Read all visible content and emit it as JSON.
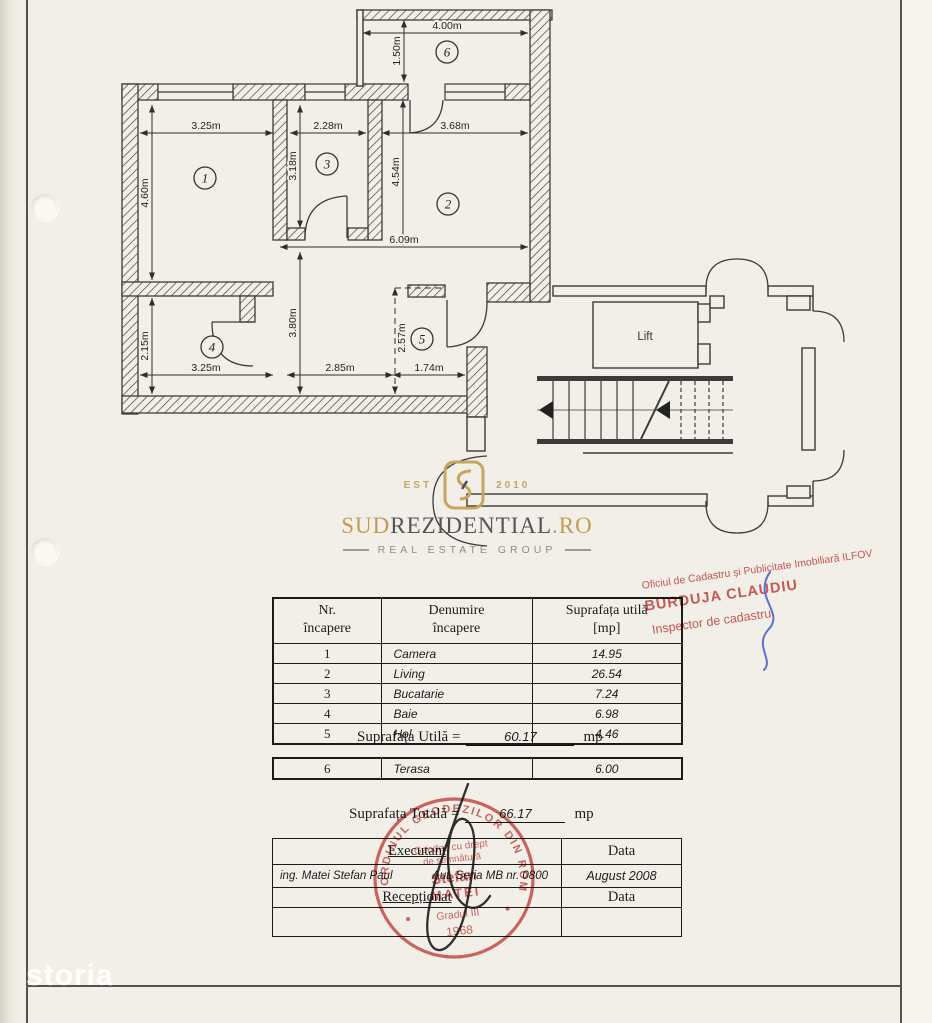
{
  "colors": {
    "stamp_red": "#cf4f4b",
    "logo_gold": "#c39a55",
    "ink": "#3b3b3b"
  },
  "watermark": "storia",
  "plan": {
    "lift_label": "Lift",
    "room_numbers": {
      "r1": "1",
      "r2": "2",
      "r3": "3",
      "r4": "4",
      "r5": "5",
      "r6": "6"
    },
    "dims": {
      "terasa_w": "4.00m",
      "terasa_h": "1.50m",
      "room1_w": "3.25m",
      "room3_w": "2.28m",
      "room2_w": "3.68m",
      "room1_h": "4.60m",
      "room3_h": "3.18m",
      "room2_h": "4.54m",
      "hall_w": "6.09m",
      "hall_h": "3.80m",
      "room5_h": "2.57m",
      "room4_h": "2.15m",
      "room4_w": "3.25m",
      "hall2_w": "2.85m",
      "room5_w": "1.74m"
    }
  },
  "logo": {
    "est": "EST",
    "year": "2010",
    "brand_prefix": "SUD",
    "brand_main": "REZIDENTIAL",
    "brand_tld": ".RO",
    "tagline": "REAL ESTATE GROUP"
  },
  "area_table": {
    "headers": [
      {
        "l1": "Nr.",
        "l2": "încapere"
      },
      {
        "l1": "Denumire",
        "l2": "încapere"
      },
      {
        "l1": "Suprafața utilă",
        "l2": "[mp]"
      }
    ],
    "rows": [
      {
        "nr": "1",
        "name": "Camera",
        "area": "14.95"
      },
      {
        "nr": "2",
        "name": "Living",
        "area": "26.54"
      },
      {
        "nr": "3",
        "name": "Bucatarie",
        "area": "7.24"
      },
      {
        "nr": "4",
        "name": "Baie",
        "area": "6.98"
      },
      {
        "nr": "5",
        "name": "Hol",
        "area": "4.46"
      }
    ],
    "terasa_row": {
      "nr": "6",
      "name": "Terasa",
      "area": "6.00"
    }
  },
  "totals": {
    "util_label": "Suprafața Utilă =",
    "util_value": "60.17",
    "util_unit": "mp",
    "total_label": "Suprafața Totală =",
    "total_value": "66.17",
    "total_unit": "mp"
  },
  "exec_table": {
    "executant_label": "Executant",
    "date_header": "Data",
    "executant_name": "ing. Matei Stefan Paul",
    "authorization": "Aut. Seria MB nr. 0800",
    "date_value": "August 2008",
    "receptionat_label": "Recepționat",
    "date_header2": "Data"
  },
  "stamps": {
    "office": {
      "line1": "Oficiul de Cadastru și Publicitate Imobiliară ILFOV",
      "line2": "BURDUJA CLAUDIU",
      "line3": "Inspector de cadastru"
    },
    "round": {
      "rim": "ORDINUL GEODEZILOR DIN ROMANIA",
      "l1": "Geodez cu drept",
      "l2": "de semnătură",
      "l3": "Stefan",
      "l4": "MATEI",
      "l5": "Gradul III",
      "l6": "1968"
    }
  }
}
